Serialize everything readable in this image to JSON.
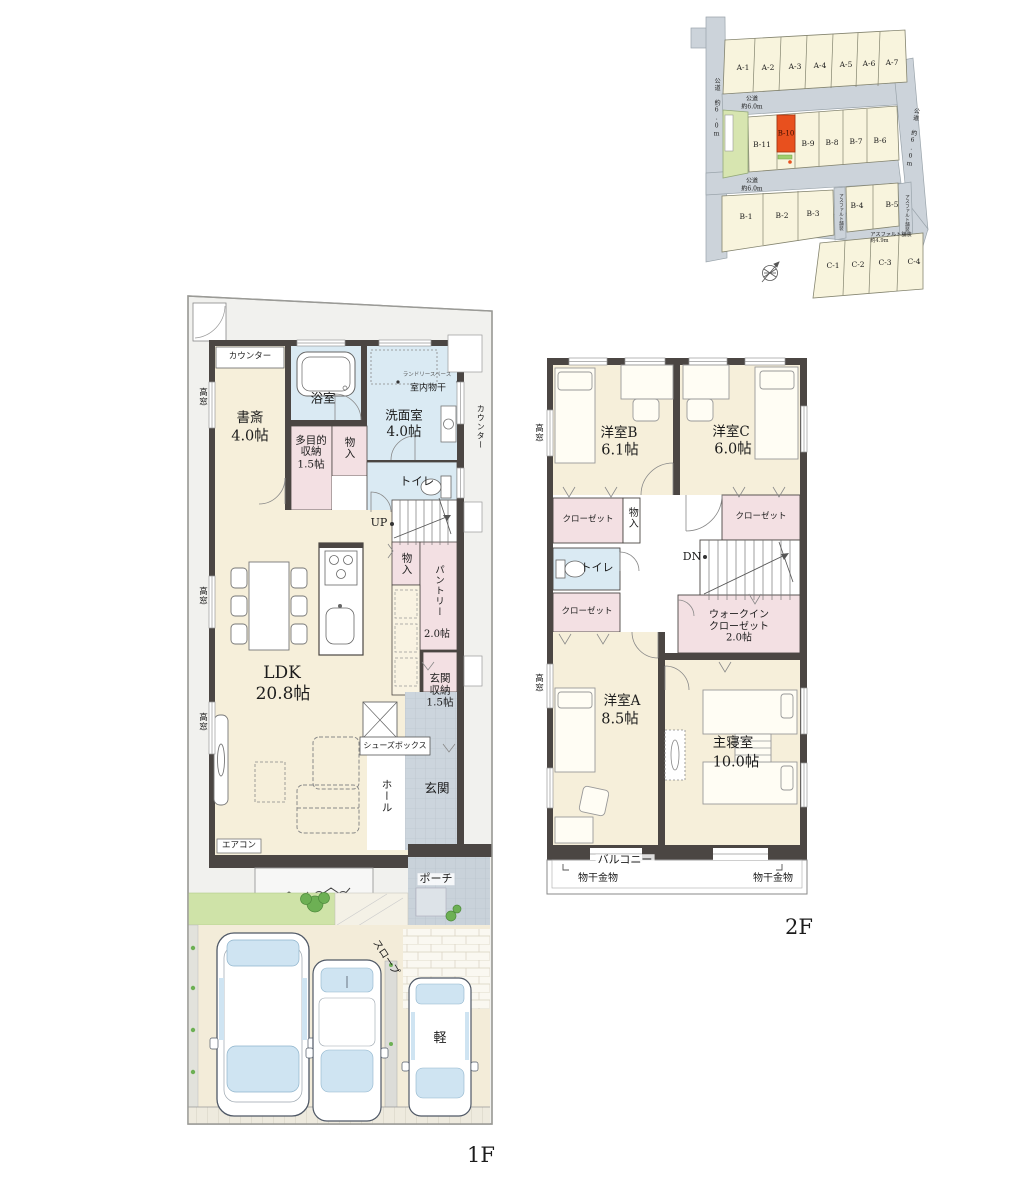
{
  "site": {
    "lots_a": [
      "A-1",
      "A-2",
      "A-3",
      "A-4",
      "A-5",
      "A-6",
      "A-7"
    ],
    "lots_b_upper": [
      "B-11",
      "B-10",
      "B-9",
      "B-8",
      "B-7",
      "B-6"
    ],
    "lots_b_lower": [
      "B-1",
      "B-2",
      "B-3",
      "B-4",
      "B-5"
    ],
    "lots_c": [
      "C-1",
      "C-2",
      "C-3",
      "C-4"
    ],
    "highlight_lot": "B-10",
    "road_name": "公道",
    "road_width": "約6.0m",
    "road_full": "公道 約6.0m",
    "asphalt": "アスファルト舗装",
    "asphalt_width": "約4.9m"
  },
  "floor1": {
    "label": "1F",
    "counter": "カウンター",
    "high_window": "高窓",
    "study": {
      "name": "書斎",
      "size": "4.0帖"
    },
    "bath": "浴室",
    "laundry_space": "ランドリースペース",
    "indoor_drying": "室内物干",
    "washroom": {
      "name": "洗面室",
      "size": "4.0帖"
    },
    "multi_storage": {
      "name": "多目的収納",
      "size": "1.5帖"
    },
    "storage": "物入",
    "toilet": "トイレ",
    "up": "UP",
    "ldk": {
      "name": "LDK",
      "size": "20.8帖"
    },
    "pantry": {
      "name": "パントリー",
      "size": "2.0帖"
    },
    "entrance_storage": {
      "l1": "玄関",
      "l2": "収納",
      "size": "1.5帖"
    },
    "shoes_box": "シューズボックス",
    "hall": "ホール",
    "entrance": "玄関",
    "aircon": "エアコン",
    "porch": "ポーチ",
    "slope": "スロープ",
    "kei": "軽"
  },
  "floor2": {
    "label": "2F",
    "high_window": "高窓",
    "room_b": {
      "name": "洋室B",
      "size": "6.1帖"
    },
    "room_c": {
      "name": "洋室C",
      "size": "6.0帖"
    },
    "room_a": {
      "name": "洋室A",
      "size": "8.5帖"
    },
    "master": {
      "name": "主寝室",
      "size": "10.0帖"
    },
    "closet": "クローゼット",
    "storage": "物入",
    "toilet": "トイレ",
    "dn": "DN",
    "wic": {
      "l1": "ウォークイン",
      "l2": "クローゼット",
      "size": "2.0帖"
    },
    "balcony": "バルコニー",
    "drying_hw": "物干金物"
  },
  "colors": {
    "wall": "#4b4643",
    "floor": "#f6efda",
    "wet": "#daeaf3",
    "storage_pink": "#f3e0e3",
    "tile": "#ccd5dd",
    "road": "#ccd3da",
    "lot": "#f8f4dd",
    "highlight": "#e8501e",
    "park": "#d7e5b0",
    "grass": "#cfe3a8",
    "glass": "#cfe4f2"
  }
}
